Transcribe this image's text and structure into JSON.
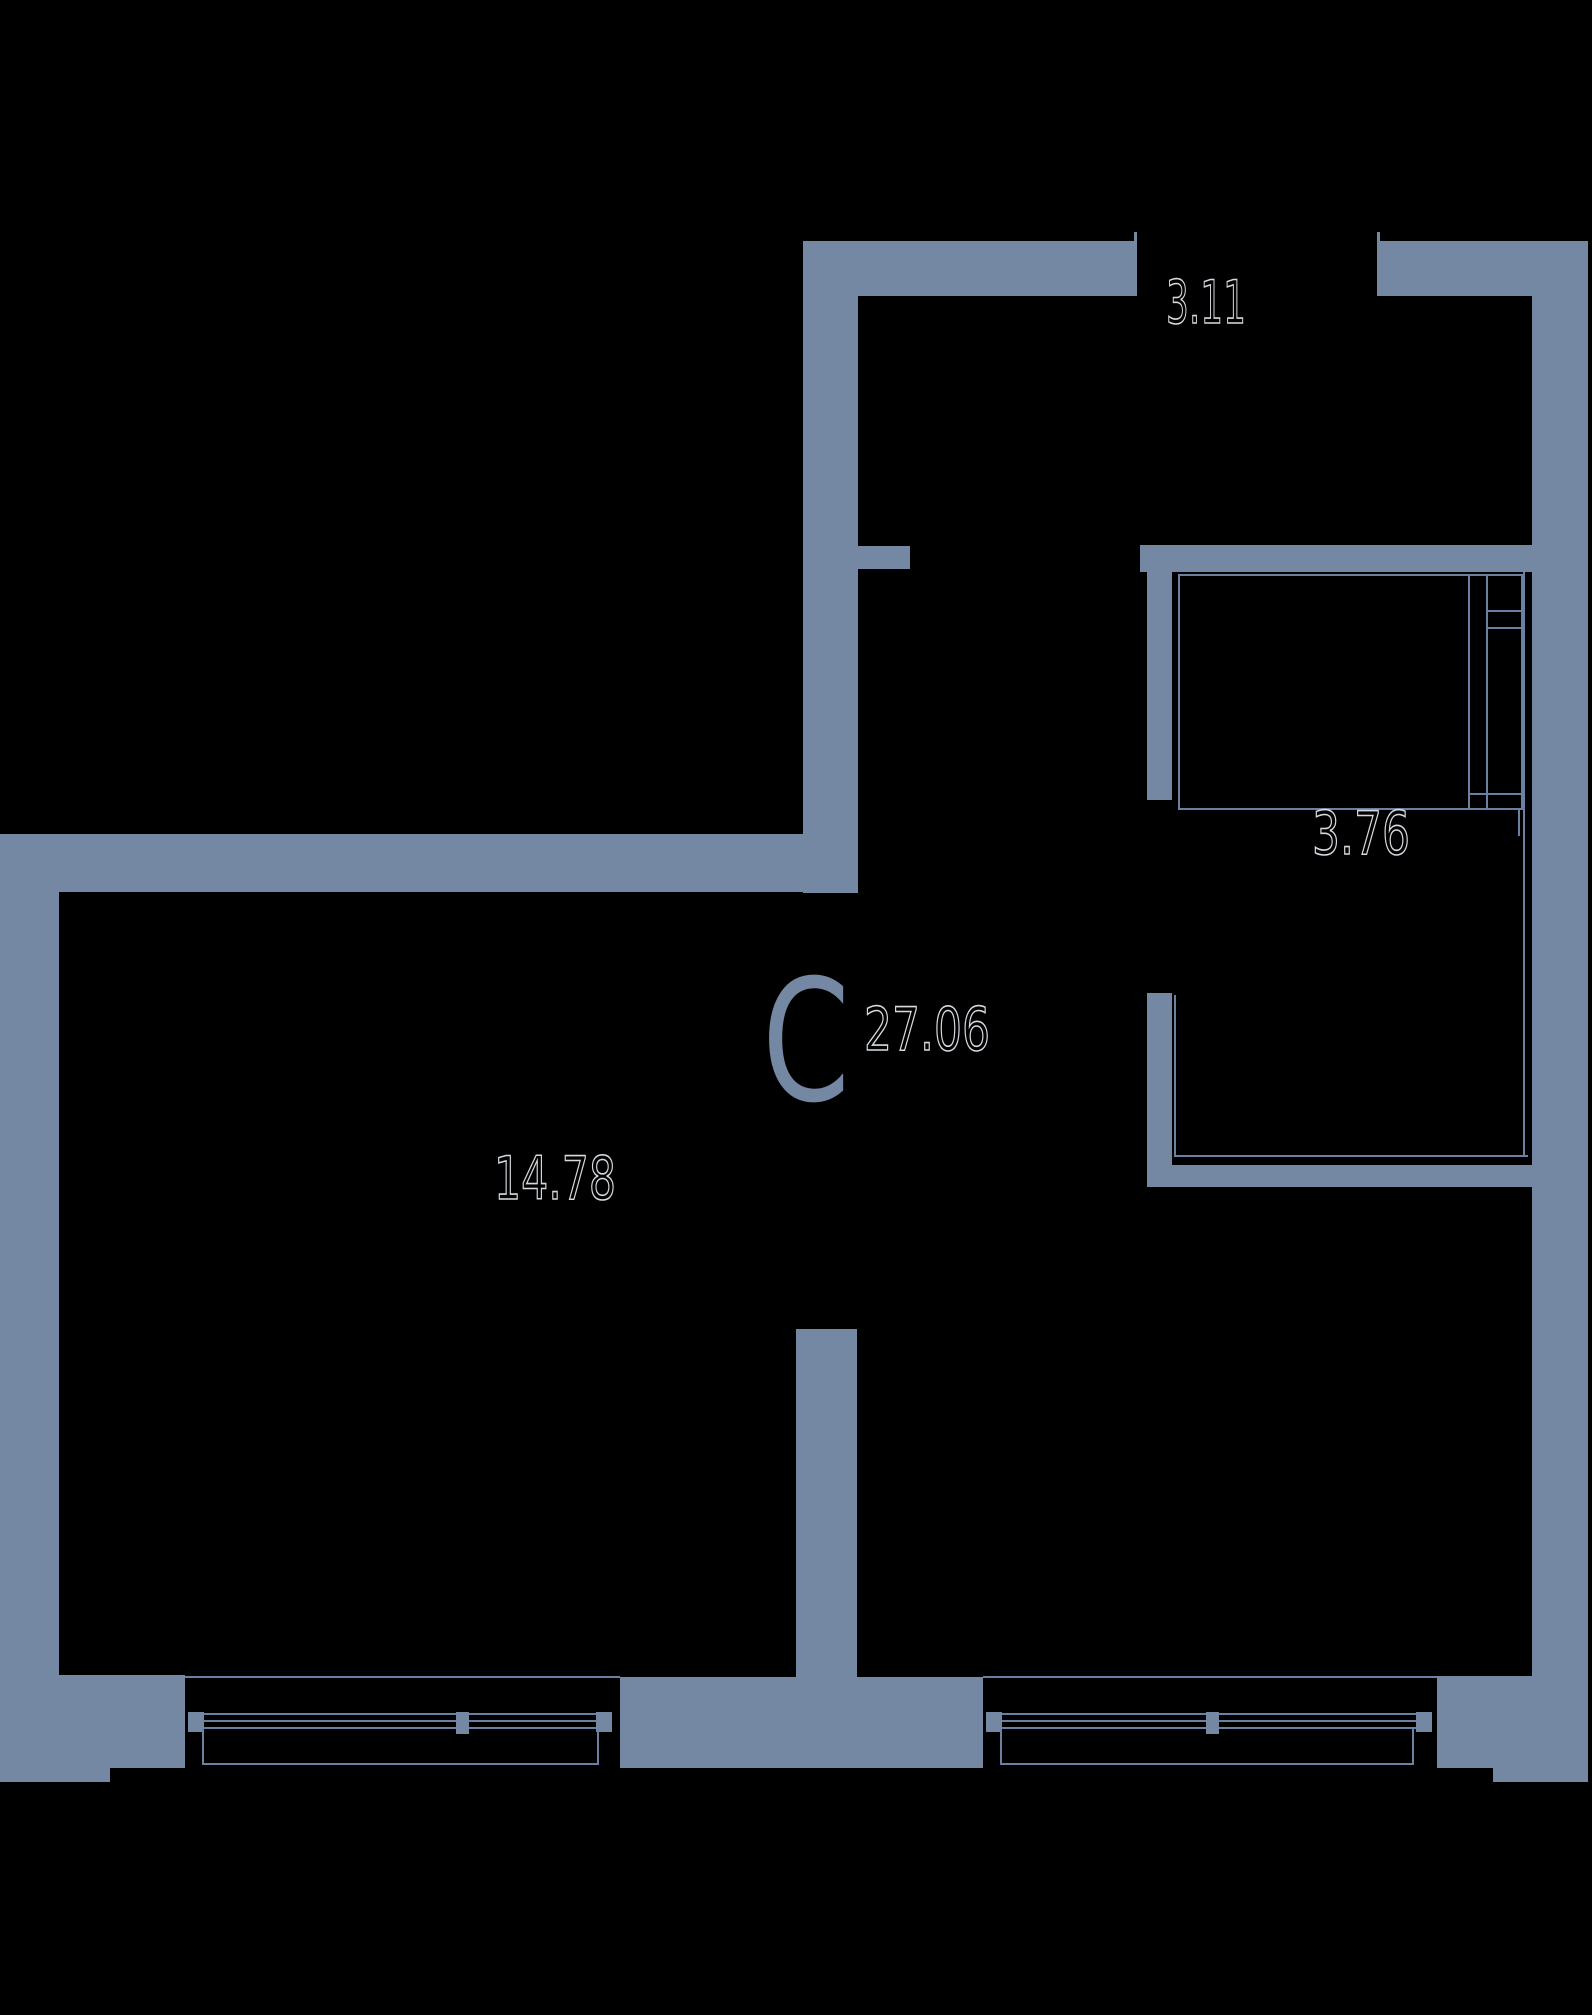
{
  "floor_plan": {
    "unit": {
      "type_label": "C",
      "total_area": "27.06"
    },
    "areas": {
      "hallway": "3.11",
      "storage": "3.76",
      "living": "14.78"
    },
    "colors": {
      "wall": "#7488a4",
      "line": "#6a81a1",
      "bg": "#000000",
      "outline": "#d6dade"
    }
  }
}
